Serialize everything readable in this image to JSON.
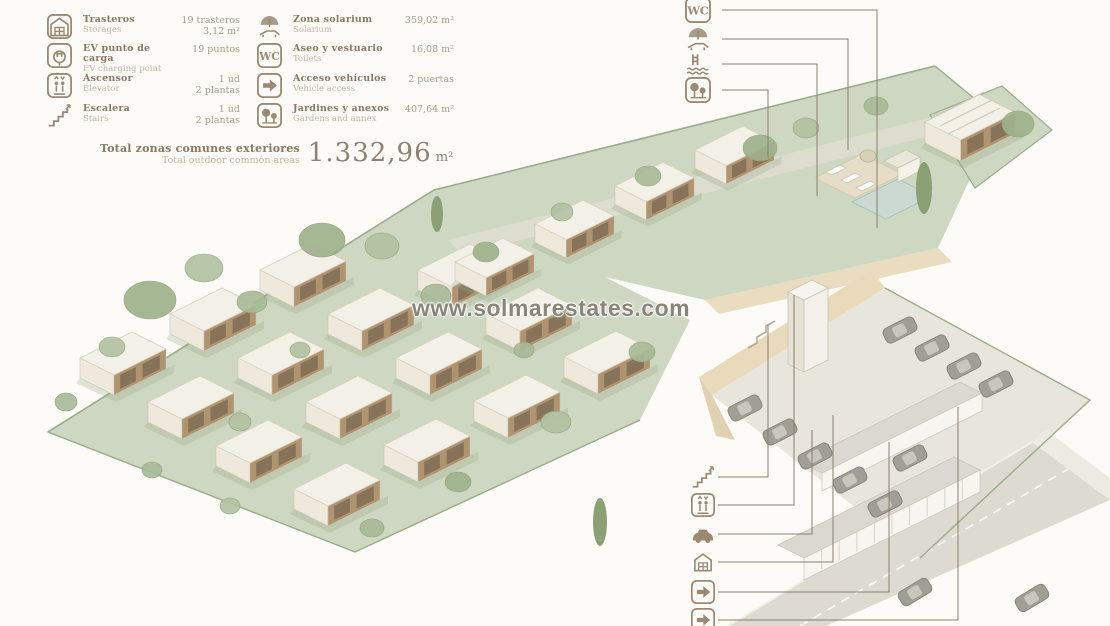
{
  "watermark": "www.solmarestates.com",
  "legend": {
    "left_rows": [
      {
        "icon": "car",
        "label_es": "",
        "label_en": "Outdoor parking",
        "value_lines": [
          "11,5 m²"
        ],
        "partial": true
      },
      {
        "icon": "storage",
        "label_es": "Trasteros",
        "label_en": "Storages",
        "value_lines": [
          "19 trasteros",
          "3,12 m²"
        ],
        "partial": false
      },
      {
        "icon": "ev",
        "label_es": "EV punto de carga",
        "label_en": "EV charging point",
        "value_lines": [
          "19 puntos"
        ],
        "partial": false
      },
      {
        "icon": "elevator",
        "label_es": "Ascensor",
        "label_en": "Elevator",
        "value_lines": [
          "1 ud",
          "2 plantas"
        ],
        "partial": false
      },
      {
        "icon": "stairs",
        "label_es": "Escalera",
        "label_en": "Stairs",
        "value_lines": [
          "1 ud",
          "2 plantas"
        ],
        "partial": false
      }
    ],
    "right_rows": [
      {
        "icon": "pool",
        "label_es": "",
        "label_en": "Swimming pool",
        "value_lines": [
          ""
        ],
        "partial": true
      },
      {
        "icon": "solarium",
        "label_es": "Zona solarium",
        "label_en": "Solarium",
        "value_lines": [
          "359,02 m²"
        ],
        "partial": false
      },
      {
        "icon": "wc",
        "label_es": "Aseo y vestuario",
        "label_en": "Toilets",
        "value_lines": [
          "16,08 m²"
        ],
        "partial": false
      },
      {
        "icon": "arrow",
        "label_es": "Acceso vehículos",
        "label_en": "Vehicle access",
        "value_lines": [
          "2 puertas"
        ],
        "partial": false
      },
      {
        "icon": "trees",
        "label_es": "Jardines y anexos",
        "label_en": "Gardens and annex",
        "value_lines": [
          "407,64 m²"
        ],
        "partial": false
      }
    ],
    "total": {
      "label_es": "Total zonas comunes exteriores",
      "label_en": "Total outdoor common areas",
      "value_main": "1.332,96",
      "value_unit": " m²"
    }
  },
  "callouts": {
    "top": [
      {
        "icon": "wc",
        "boxed": true
      },
      {
        "icon": "solarium",
        "boxed": false
      },
      {
        "icon": "pool",
        "boxed": false
      },
      {
        "icon": "trees",
        "boxed": true
      }
    ],
    "bottom": [
      {
        "icon": "stairs",
        "boxed": false
      },
      {
        "icon": "elevator",
        "boxed": true
      },
      {
        "icon": "car",
        "boxed": false
      },
      {
        "icon": "storage",
        "boxed": false
      },
      {
        "icon": "arrow",
        "boxed": true
      },
      {
        "icon": "arrow",
        "boxed": true
      }
    ]
  },
  "icons": {
    "wc_text": "WC"
  },
  "colors": {
    "accent": "#9b8974",
    "label": "#8a7964",
    "sublabel": "#c1b6a6",
    "value": "#a79c8c",
    "total_number": "#8d8174",
    "watermark": "#8a857a",
    "leader": "#8a8070",
    "field_green": "#cdd7c1",
    "veg1": "#9fb28c",
    "veg2": "#b3c2a3",
    "veg3": "#a9ba98",
    "cypress": "#8ba075",
    "roof": "#f3f0e8",
    "face_light": "#efe9dc",
    "face_wood": "#b0936f",
    "window": "#6b5e4c",
    "road": "#dcdad1",
    "walk": "#e0ddd2",
    "parking": "#e7e5dc",
    "wall": "#eadcc0",
    "wall2": "#e8dabb",
    "building_face": "#f7f5ef",
    "building_roof": "#dad8d0",
    "car_body": "#a09e95",
    "car_glass": "#c8c6bd",
    "pool_water": "#ccd8d2",
    "deck": "#e6ddc9",
    "fence": "#9cab8b",
    "outline": "#c9c4b6"
  }
}
